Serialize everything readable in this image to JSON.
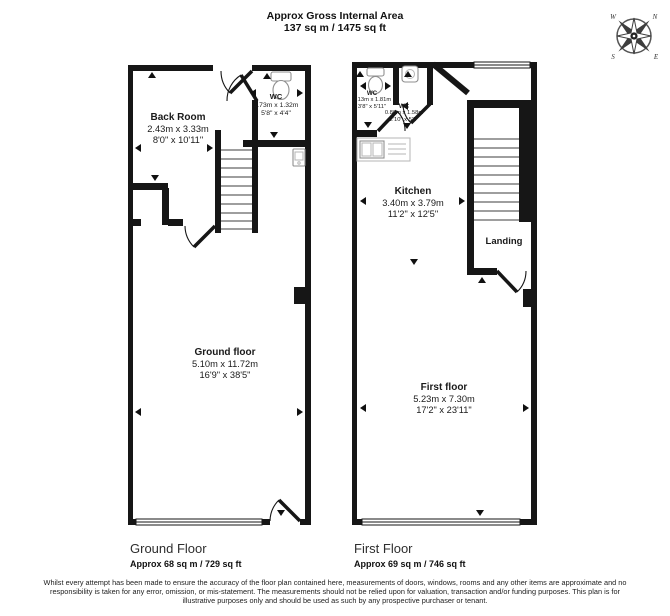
{
  "header": {
    "title_line1": "Approx Gross Internal Area",
    "title_line2": "137 sq m / 1475 sq ft"
  },
  "compass": {
    "n": "N",
    "e": "E",
    "s": "S",
    "w": "W"
  },
  "colors": {
    "wall": "#161616",
    "fixture_outline": "#8f8f8f",
    "background": "#ffffff"
  },
  "icons": {
    "compass": "compass-rose-icon",
    "toilet": "toilet-icon",
    "basin": "basin-icon",
    "kitchen_sink": "kitchen-sink-icon"
  },
  "ground_floor": {
    "rooms": {
      "back_room": {
        "name": "Back Room",
        "dims_m": "2.43m x 3.33m",
        "dims_ft": "8'0\" x 10'11\""
      },
      "wc": {
        "name": "WC",
        "dims_m": "1.73m x 1.32m",
        "dims_ft": "5'8\" x 4'4\""
      },
      "main": {
        "name": "Ground floor",
        "dims_m": "5.10m x 11.72m",
        "dims_ft": "16'9\" x 38'5\""
      }
    },
    "caption": {
      "title": "Ground Floor",
      "area": "Approx 68 sq m / 729 sq ft"
    }
  },
  "first_floor": {
    "rooms": {
      "wc1": {
        "name": "WC",
        "dims_m": "1.13m x 1.81m",
        "dims_ft": "3'8\" x 5'11\""
      },
      "wc2": {
        "name": "WC",
        "dims_m": "0.86m x 1.58m",
        "dims_ft": "2'10\" x 5'2\""
      },
      "kitchen": {
        "name": "Kitchen",
        "dims_m": "3.40m x 3.79m",
        "dims_ft": "11'2\" x 12'5\""
      },
      "landing": {
        "name": "Landing"
      },
      "main": {
        "name": "First floor",
        "dims_m": "5.23m x 7.30m",
        "dims_ft": "17'2\" x 23'11\""
      }
    },
    "caption": {
      "title": "First Floor",
      "area": "Approx 69 sq m / 746 sq ft"
    }
  },
  "disclaimer": "Whilst every attempt has been made to ensure the accuracy of the floor plan contained here, measurements of doors, windows, rooms and any other items are approximate and no responsibility is taken for any error, omission, or mis-statement. The measurements should not be relied upon for valuation, transaction and/or funding purposes. This plan is for illustrative purposes only and should be used as such by any prospective purchaser or tenant."
}
